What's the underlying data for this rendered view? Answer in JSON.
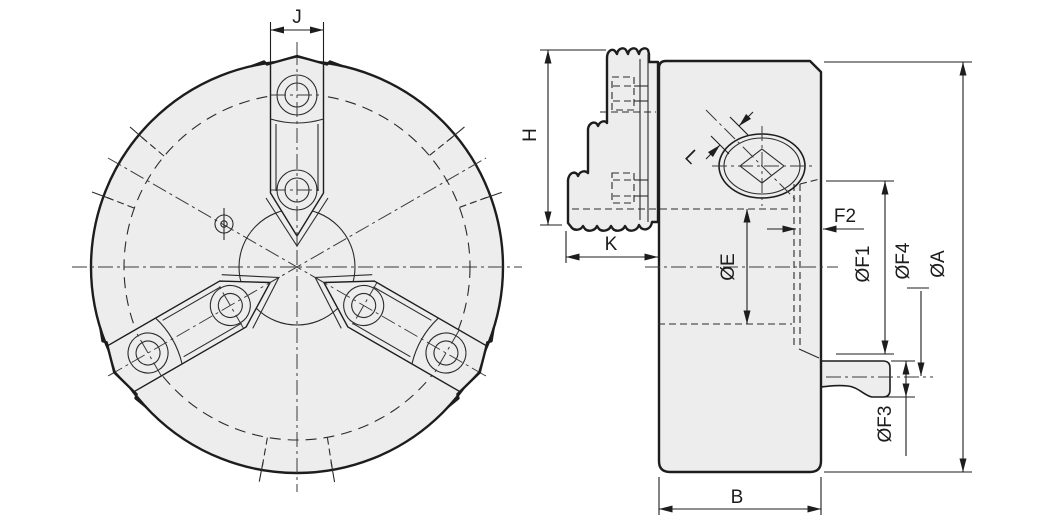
{
  "colors": {
    "line": "#1d1d1d",
    "fill": "#ededed",
    "background": "#ffffff"
  },
  "front_view": {
    "labels": {
      "j": "J"
    }
  },
  "side_view": {
    "labels": {
      "h": "H",
      "k": "K",
      "l": "L",
      "f2": "F2",
      "e": "ØE",
      "f1": "ØF1",
      "f4": "ØF4",
      "a": "ØA",
      "f3": "ØF3",
      "b": "B"
    }
  }
}
